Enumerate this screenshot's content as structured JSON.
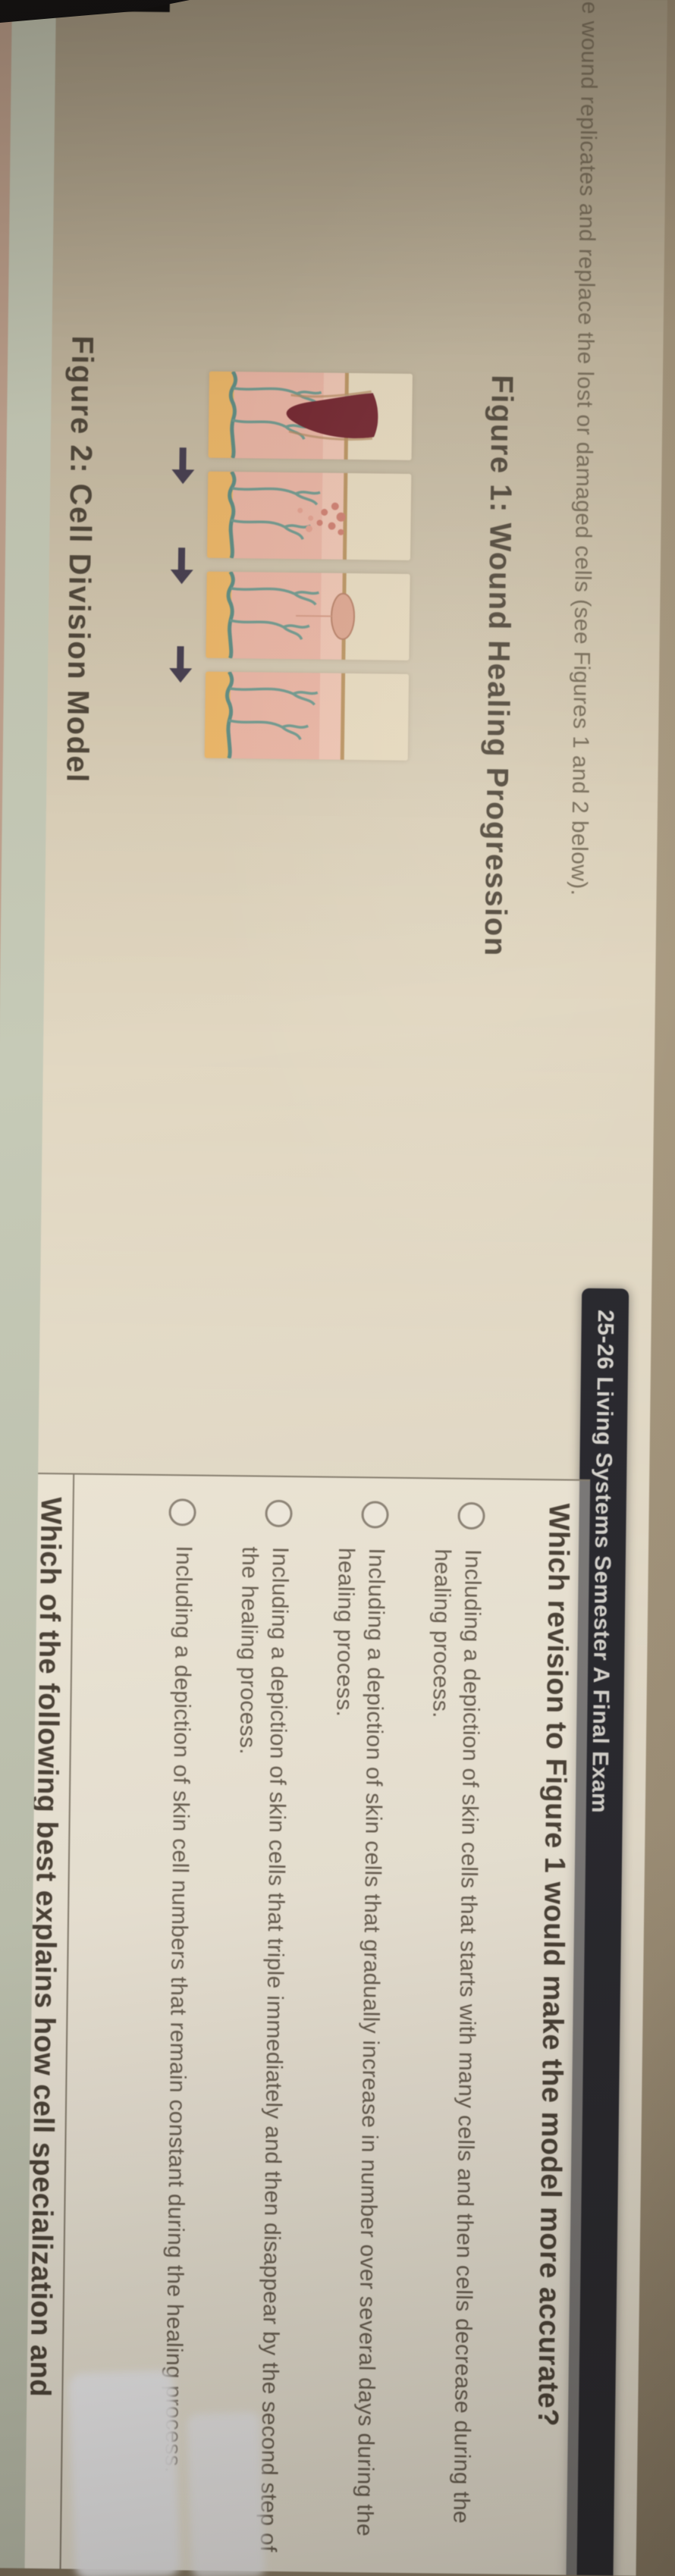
{
  "banner": {
    "title": "25-26 Living Systems Semester A Final Exam"
  },
  "passage": {
    "stem_fragment": "he wound replicates and replace the lost or damaged cells (see Figures 1 and 2 below)."
  },
  "figure1": {
    "caption": "Figure 1: Wound Healing Progression",
    "stages": [
      {
        "name": "wound-with-blood-clot"
      },
      {
        "name": "granulation-tissue-forming"
      },
      {
        "name": "wound-closing-scab"
      },
      {
        "name": "healed-skin"
      }
    ]
  },
  "figure2": {
    "caption": "Figure 2: Cell Division Model"
  },
  "question1": {
    "text": "Which revision to Figure 1 would make the model more accurate?",
    "options": [
      "Including a depiction of skin cells that starts with many cells and then cells decrease during the healing process.",
      "Including a depiction of skin cells that gradually increase in number over several days during the healing process.",
      "Including a depiction of skin cells that triple immediately and then disappear by the second step of the healing process.",
      "Including a depiction of skin cell numbers that remain constant during the healing process."
    ]
  },
  "question2": {
    "text_fragment": "Which of the following best explains how cell specialization and"
  },
  "icons": {
    "stage_arrow": "arrow-right",
    "option_radio": "radio-circle"
  },
  "colors": {
    "banner_bg": "#2a2a31",
    "page_beige": "#e9dfc9",
    "clot_red": "#7a2530",
    "vessel_teal": "#5e9086",
    "band_sage": "#c6cab6"
  }
}
